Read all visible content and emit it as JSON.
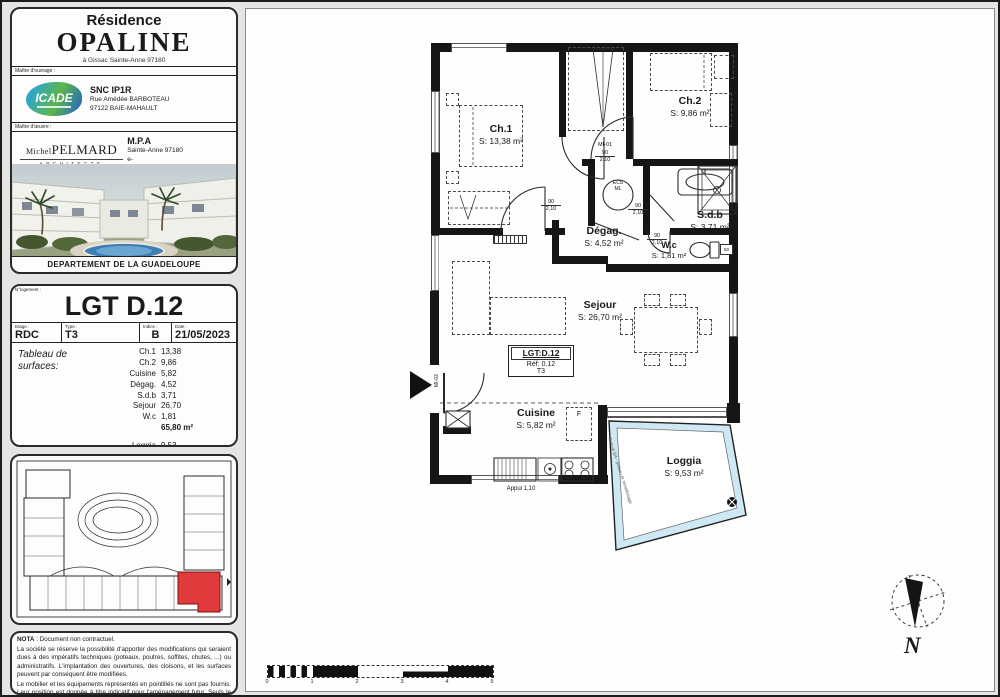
{
  "panel": {
    "title": {
      "residence": "Résidence",
      "name": "OPALINE",
      "address": "à Gissac Sainte-Anne 97180"
    },
    "owner": {
      "label": "Maître d'ouvrage :",
      "logo": "ICADE",
      "company": "SNC IP1R",
      "street": "Rue Amédée BARBOTEAU",
      "city": "97122 BAIE-MAHAULT"
    },
    "architect": {
      "label": "Maître d'œuvre :",
      "logo_first": "Michel",
      "logo_last": "PELMARD",
      "logo_sub": "ARCHITECTE",
      "company": "M.P.A",
      "city": "Sainte-Anne 97180",
      "email": "e-mail.archi.michelpelmard@gmail.com"
    },
    "photo_caption": "DEPARTEMENT DE LA GUADELOUPE"
  },
  "unit": {
    "header_label": "N°logement :",
    "name": "LGT D.12",
    "fields": [
      {
        "label": "Etage :",
        "value": "RDC"
      },
      {
        "label": "Type :",
        "value": "T3"
      },
      {
        "label": "Indice :",
        "value": "B"
      },
      {
        "label": "Date :",
        "value": "21/05/2023"
      }
    ],
    "surfaces_title": "Tableau de surfaces:",
    "rows": [
      {
        "label": "Ch.1",
        "value": "13,38"
      },
      {
        "label": "Ch.2",
        "value": "9,86"
      },
      {
        "label": "Cuisine",
        "value": "5,82"
      },
      {
        "label": "Dégag.",
        "value": "4,52"
      },
      {
        "label": "S.d.b",
        "value": "3,71"
      },
      {
        "label": "Sejour",
        "value": "26,70"
      },
      {
        "label": "W.c",
        "value": "1,81"
      }
    ],
    "total": "65,80 m²",
    "loggia_row": {
      "label": "Loggia",
      "value": "9,53"
    }
  },
  "nota": {
    "title": "NOTA",
    "intro": " : Document non contractuel.",
    "p1": "La société se réserve la possibilité d'apporter des modifications qui seraient dues à des impératifs techniques (poteaux, poutres, soffites, chutes, ...) ou administratifs. L'implantation des ouvertures, des cloisons, et les surfaces peuvent par conséquent être modifiées.",
    "p2": "Le mobilier et les équipements représentés en pointillés ne sont pas fournis. Leur position est donnée à titre indicatif pour l'aménagement futur. Seuls le lavabo, la douche et les WC sont fournis, tel que décrit dans la Notice Descriptive Sommaire."
  },
  "plan": {
    "rooms": [
      {
        "name": "Ch.1",
        "area": "S: 13,38 m²"
      },
      {
        "name": "Ch.2",
        "area": "S: 9,86 m²"
      },
      {
        "name": "S.d.b",
        "area": "S: 3,71 m²"
      },
      {
        "name": "Dégag.",
        "area": "S: 4,52 m²"
      },
      {
        "name": "W.c",
        "area": "S: 1,81 m²"
      },
      {
        "name": "Sejour",
        "area": "S: 26,70 m²"
      },
      {
        "name": "Cuisine",
        "area": "S: 5,82 m²"
      },
      {
        "name": "Loggia",
        "area": "S: 9,53 m²"
      }
    ],
    "tag": {
      "line1": "LGT:D.12",
      "line2": "Réf: 0.12",
      "line3": "T3"
    },
    "labels": {
      "mi01": "MI-01",
      "mi03": "MI-03",
      "door_w": "90",
      "door_h": "2,10",
      "ecs_top": "ECS",
      "ecs_bot": "ML",
      "fridge": "F",
      "wc_tag": "50",
      "appui": "Appui 1,10",
      "loggia_edge": "Relevé BA - poteau et remplissage"
    },
    "north": "N",
    "scale": [
      "0",
      "1",
      "2",
      "3",
      "4",
      "5"
    ]
  }
}
